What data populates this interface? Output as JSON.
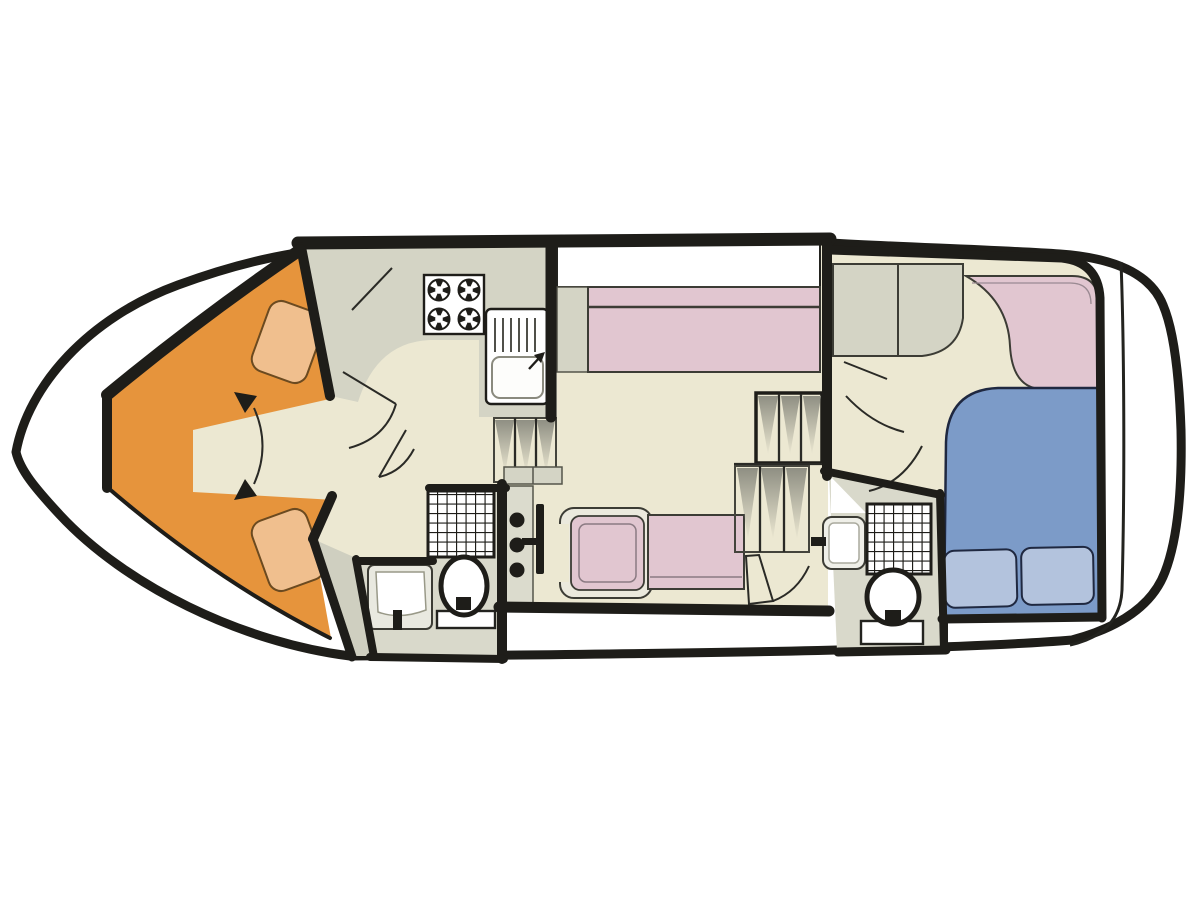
{
  "meta": {
    "kind": "boat-interior-deck-floor-plan",
    "orientation": "bow-left-stern-right"
  },
  "colors": {
    "wall": "#1e1d19",
    "hull_fill": "#ffffff",
    "floor_cream": "#ece8d2",
    "floor_gray": "#d9d9cb",
    "wedge_gray": "#cfcfc0",
    "counter_gray": "#d4d4c5",
    "console_gray": "#dbdbcd",
    "berth_orange": "#e6943c",
    "pillow_orange": "#f0bf8e",
    "pillow_orange_edge": "#6b4a20",
    "seat_pink": "#e1c6d0",
    "chair_trim": "#ebe9dd",
    "bed_blue": "#7c9bc8",
    "pillow_blue": "#b3c3dd",
    "bed_edge": "#1f2840",
    "fixture_white": "#ffffff",
    "stair_shade": "#8f8f83"
  },
  "regions": [
    {
      "label": "bow V-berth cabin"
    },
    {
      "label": "galley"
    },
    {
      "label": "forward bathroom"
    },
    {
      "label": "helm station"
    },
    {
      "label": "salon"
    },
    {
      "label": "aft bathroom"
    },
    {
      "label": "aft cabin"
    }
  ],
  "fixtures": [
    {
      "label": "v-berth with two pillows"
    },
    {
      "label": "four-burner stove"
    },
    {
      "label": "sink with drainer"
    },
    {
      "label": "companionway steps"
    },
    {
      "label": "shower grid (forward)"
    },
    {
      "label": "washbasin (forward)"
    },
    {
      "label": "toilet (forward)"
    },
    {
      "label": "helm console with wheel"
    },
    {
      "label": "helm chair"
    },
    {
      "label": "dinette bench"
    },
    {
      "label": "side bench with backrest"
    },
    {
      "label": "staircase"
    },
    {
      "label": "aft cabinets"
    },
    {
      "label": "aft corner sofa"
    },
    {
      "label": "double bed with two pillows"
    },
    {
      "label": "shower grid (aft)"
    },
    {
      "label": "washbasin (aft)"
    },
    {
      "label": "toilet (aft)"
    }
  ]
}
